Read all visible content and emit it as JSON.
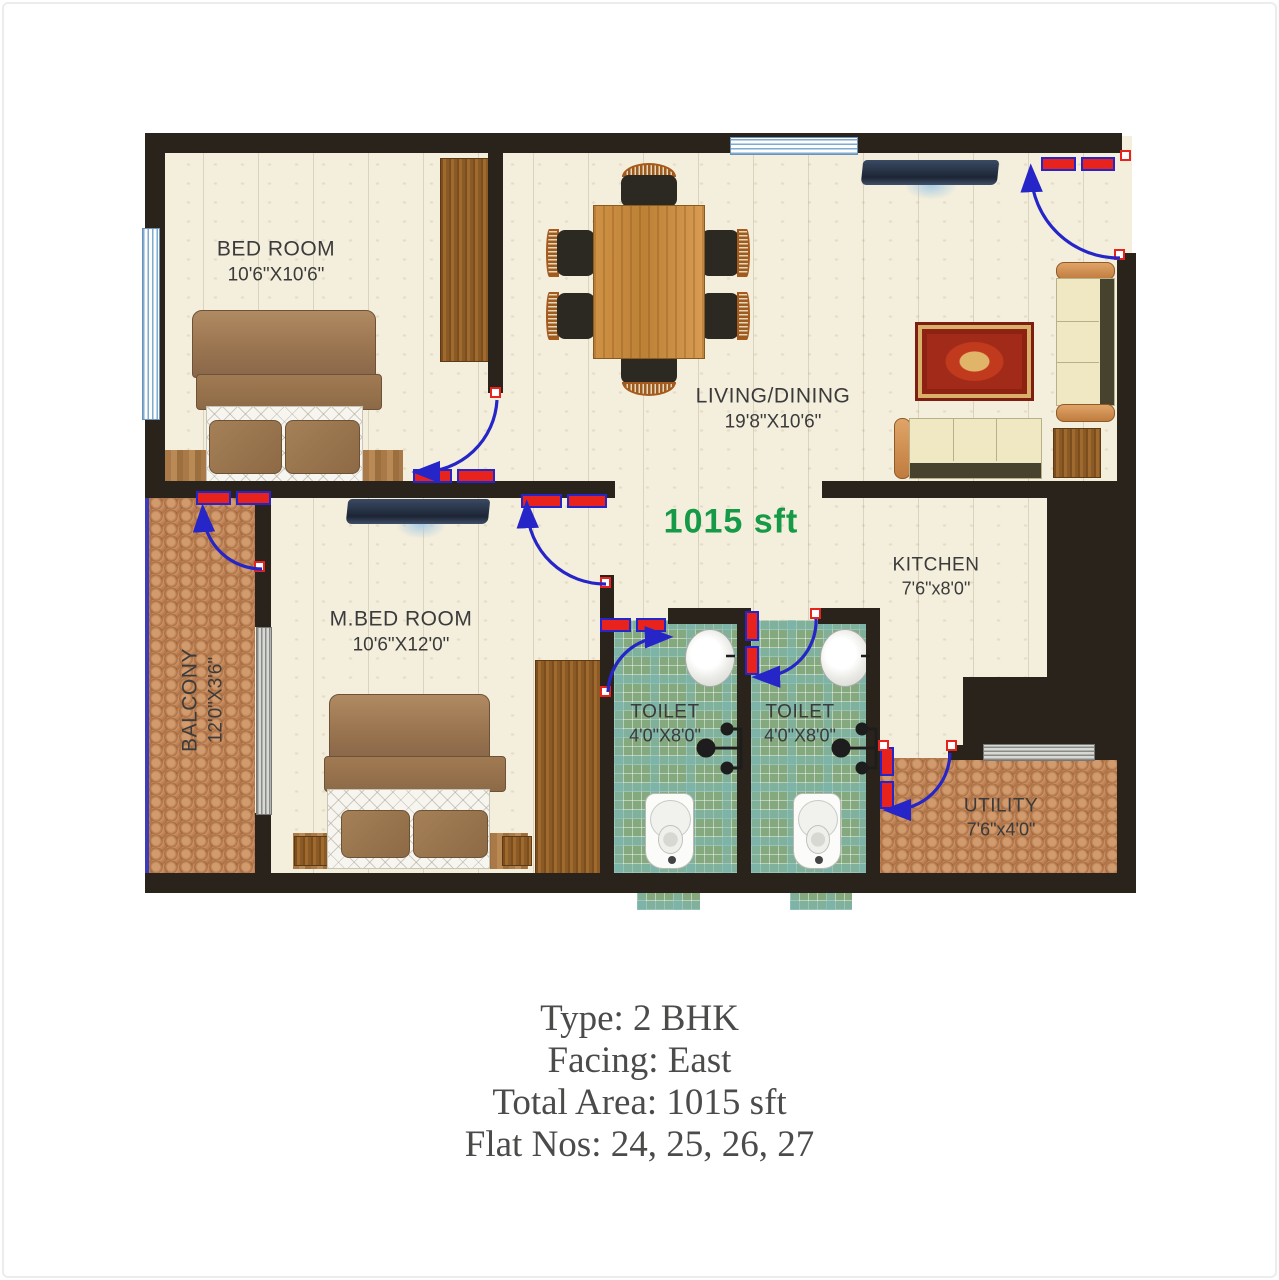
{
  "plan": {
    "area_label": "1015 sft",
    "rooms": {
      "bedroom": {
        "name": "BED ROOM",
        "dims": "10'6\"X10'6\""
      },
      "living": {
        "name": "LIVING/DINING",
        "dims": "19'8\"X10'6\""
      },
      "mbedroom": {
        "name": "M.BED ROOM",
        "dims": "10'6\"X12'0\""
      },
      "balcony": {
        "name": "BALCONY",
        "dims": "12'0\"X3'6\""
      },
      "kitchen": {
        "name": "KITCHEN",
        "dims": "7'6\"x8'0\""
      },
      "toilet1": {
        "name": "TOILET",
        "dims": "4'0\"X8'0\""
      },
      "toilet2": {
        "name": "TOILET",
        "dims": "4'0\"X8'0\""
      },
      "utility": {
        "name": "UTILITY",
        "dims": "7'6\"x4'0\""
      }
    }
  },
  "caption": {
    "line1": "Type: 2 BHK",
    "line2": "Facing: East",
    "line3": "Total Area: 1015 sft",
    "line4": "Flat Nos: 24, 25, 26, 27"
  },
  "colors": {
    "wall": "#2a231c",
    "door_leaf": "#e8231e",
    "door_swing": "#2525c8",
    "area_label": "#169a47",
    "caption_text": "#4b4b49"
  }
}
